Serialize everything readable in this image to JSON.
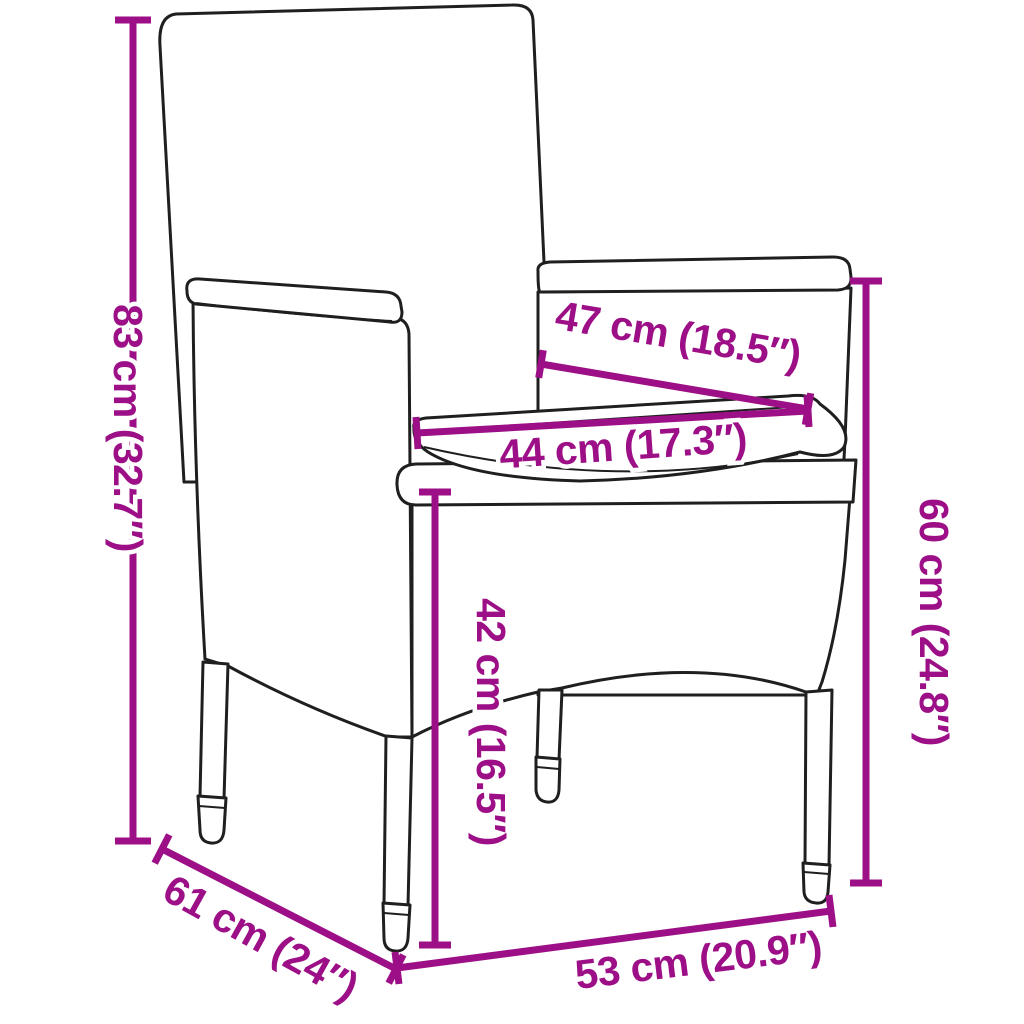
{
  "diagram": {
    "subject": "rattan-garden-chair-with-cushion",
    "accent_color": "#9C0F87",
    "line_color": "#1f1f1f",
    "background_color": "#ffffff",
    "dimensions": {
      "total_height": {
        "label": "83 cm (32.7″)",
        "cm": 83,
        "inches": 32.7
      },
      "armrest_height": {
        "label": "60 cm (24.8″)",
        "cm": 60,
        "inches": 24.8
      },
      "seat_height": {
        "label": "42 cm (16.5″)",
        "cm": 42,
        "inches": 16.5
      },
      "seat_depth_top": {
        "label": "47 cm (18.5″)",
        "cm": 47,
        "inches": 18.5
      },
      "seat_width": {
        "label": "44 cm (17.3″)",
        "cm": 44,
        "inches": 17.3
      },
      "base_depth": {
        "label": "61 cm (24″)",
        "cm": 61,
        "inches": 24
      },
      "base_width": {
        "label": "53 cm (20.9″)",
        "cm": 53,
        "inches": 20.9
      }
    }
  }
}
